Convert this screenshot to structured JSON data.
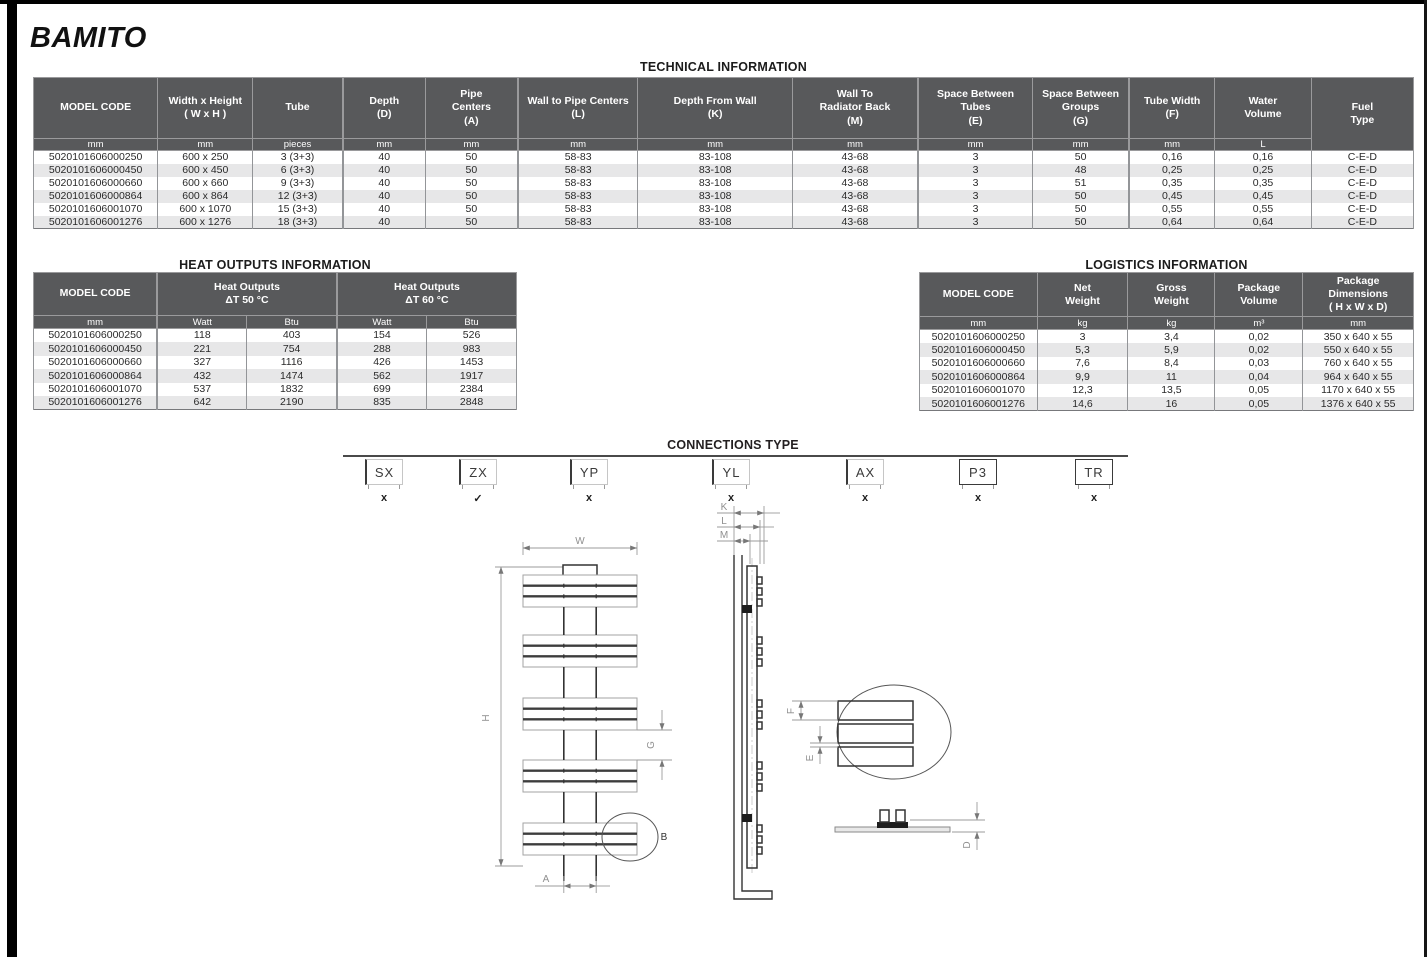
{
  "page": {
    "title": "BAMITO"
  },
  "colors": {
    "header_bg": "#58595B",
    "row_alt": "#E7E7E8",
    "border": "#939598",
    "accent_dark": "#333333"
  },
  "technical": {
    "title": "TECHNICAL INFORMATION",
    "widths": [
      9.0,
      6.9,
      6.5,
      6.0,
      6.7,
      8.7,
      11.2,
      9.1,
      8.3,
      7.0,
      6.2,
      7.0,
      7.4
    ],
    "header": [
      {
        "label": "MODEL CODE"
      },
      {
        "label": "Width x Height\n( W x H )"
      },
      {
        "label": "Tube"
      },
      {
        "label": "Depth\n(D)"
      },
      {
        "label": "Pipe\nCenters\n(A)"
      },
      {
        "label": "Wall to Pipe Centers\n(L)"
      },
      {
        "label": "Depth From Wall\n(K)"
      },
      {
        "label": "Wall To\nRadiator Back\n(M)"
      },
      {
        "label": "Space Between\nTubes\n(E)"
      },
      {
        "label": "Space Between\nGroups\n(G)"
      },
      {
        "label": "Tube Width\n(F)"
      },
      {
        "label": "Water\nVolume"
      },
      {
        "label": "Fuel\nType",
        "rowspan": 2
      }
    ],
    "units": [
      "mm",
      "mm",
      "pieces",
      "mm",
      "mm",
      "mm",
      "mm",
      "mm",
      "mm",
      "mm",
      "mm",
      "L"
    ],
    "rows": [
      [
        "5020101606000250",
        "600 x 250",
        "3 (3+3)",
        "40",
        "50",
        "58-83",
        "83-108",
        "43-68",
        "3",
        "50",
        "0,16",
        "0,16",
        "C-E-D"
      ],
      [
        "5020101606000450",
        "600 x 450",
        "6 (3+3)",
        "40",
        "50",
        "58-83",
        "83-108",
        "43-68",
        "3",
        "48",
        "0,25",
        "0,25",
        "C-E-D"
      ],
      [
        "5020101606000660",
        "600 x 660",
        "9 (3+3)",
        "40",
        "50",
        "58-83",
        "83-108",
        "43-68",
        "3",
        "51",
        "0,35",
        "0,35",
        "C-E-D"
      ],
      [
        "5020101606000864",
        "600 x 864",
        "12 (3+3)",
        "40",
        "50",
        "58-83",
        "83-108",
        "43-68",
        "3",
        "50",
        "0,45",
        "0,45",
        "C-E-D"
      ],
      [
        "5020101606001070",
        "600 x 1070",
        "15 (3+3)",
        "40",
        "50",
        "58-83",
        "83-108",
        "43-68",
        "3",
        "50",
        "0,55",
        "0,55",
        "C-E-D"
      ],
      [
        "5020101606001276",
        "600 x 1276",
        "18 (3+3)",
        "40",
        "50",
        "58-83",
        "83-108",
        "43-68",
        "3",
        "50",
        "0,64",
        "0,64",
        "C-E-D"
      ]
    ]
  },
  "heat_outputs": {
    "title": "HEAT OUTPUTS INFORMATION",
    "widths": [
      25.6,
      18.6,
      18.6,
      18.6,
      18.6
    ],
    "header": [
      {
        "label": "MODEL CODE"
      },
      {
        "label": "Heat Outputs\nΔT  50 °C",
        "span": 2
      },
      {
        "label": "Heat Outputs\nΔT  60 °C",
        "span": 2
      }
    ],
    "units": [
      "mm",
      "Watt",
      "Btu",
      "Watt",
      "Btu"
    ],
    "rows": [
      [
        "5020101606000250",
        "118",
        "403",
        "154",
        "526"
      ],
      [
        "5020101606000450",
        "221",
        "754",
        "288",
        "983"
      ],
      [
        "5020101606000660",
        "327",
        "1116",
        "426",
        "1453"
      ],
      [
        "5020101606000864",
        "432",
        "1474",
        "562",
        "1917"
      ],
      [
        "5020101606001070",
        "537",
        "1832",
        "699",
        "2384"
      ],
      [
        "5020101606001276",
        "642",
        "2190",
        "835",
        "2848"
      ]
    ]
  },
  "logistics": {
    "title": "LOGISTICS INFORMATION",
    "widths": [
      23.8,
      18.4,
      17.6,
      17.8,
      22.4
    ],
    "header": [
      {
        "label": "MODEL CODE"
      },
      {
        "label": "Net\nWeight"
      },
      {
        "label": "Gross\nWeight"
      },
      {
        "label": "Package\nVolume"
      },
      {
        "label": "Package\nDimensions\n( H x W x D)"
      }
    ],
    "units": [
      "mm",
      "kg",
      "kg",
      "m³",
      "mm"
    ],
    "rows": [
      [
        "5020101606000250",
        "3",
        "3,4",
        "0,02",
        "350 x 640 x 55"
      ],
      [
        "5020101606000450",
        "5,3",
        "5,9",
        "0,02",
        "550 x 640 x 55"
      ],
      [
        "5020101606000660",
        "7,6",
        "8,4",
        "0,03",
        "760 x 640 x 55"
      ],
      [
        "5020101606000864",
        "9,9",
        "11",
        "0,04",
        "964 x 640 x 55"
      ],
      [
        "5020101606001070",
        "12,3",
        "13,5",
        "0,05",
        "1170 x 640 x 55"
      ],
      [
        "5020101606001276",
        "14,6",
        "16",
        "0,05",
        "1376 x 640 x 55"
      ]
    ]
  },
  "connections": {
    "title": "CONNECTIONS TYPE",
    "items": [
      {
        "code": "SX",
        "status": "x"
      },
      {
        "code": "ZX",
        "status": "✓"
      },
      {
        "code": "YP",
        "status": "x"
      },
      {
        "code": "YL",
        "status": "x"
      },
      {
        "code": "AX",
        "status": "x"
      },
      {
        "code": "P3",
        "status": "x"
      },
      {
        "code": "TR",
        "status": "x"
      }
    ]
  },
  "drawing": {
    "labels": {
      "width": "W",
      "height": "H",
      "pipe_centers": "A",
      "group_gap": "G",
      "detail": "B",
      "depth_from_wall": "K",
      "wall_to_pipe_centers": "L",
      "wall_to_radiator_back": "M",
      "tube_width": "F",
      "space_between_tubes": "E",
      "depth": "D"
    }
  }
}
